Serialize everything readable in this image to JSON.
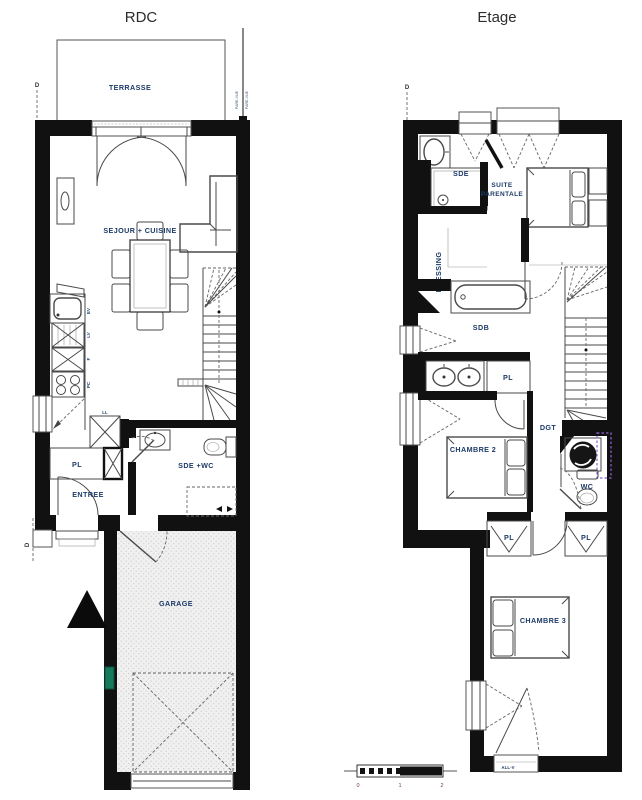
{
  "titles": {
    "rdc": "RDC",
    "etage": "Etage"
  },
  "rdc": {
    "terrasse": "TERRASSE",
    "pare_vue_left": "PARE-VUE",
    "pare_vue_right": "PARE-VUE",
    "sejour_cuisine": "SEJOUR + CUISINE",
    "kitchen": {
      "ev": "EV",
      "lv": "LV",
      "f": "F",
      "pc": "PC",
      "ll": "LL"
    },
    "pl": "PL",
    "entree": "ENTREE",
    "sde_wc": "SDE +WC",
    "garage": "GARAGE",
    "section_marker_top": "D",
    "section_marker_bottom": "D"
  },
  "etage": {
    "sde": "SDE",
    "suite_parentale_line1": "SUITE",
    "suite_parentale_line2": "PARENTALE",
    "dressing": "DRESSING",
    "sdb": "SDB",
    "pl_sdb": "PL",
    "chambre2": "CHAMBRE 2",
    "dgt": "DGT",
    "wc": "WC",
    "pl_left": "PL",
    "pl_right": "PL",
    "chambre3": "CHAMBRE 3",
    "all_v": "ALL-V",
    "section_marker_top": "D"
  },
  "scale_bar": {
    "tick0": "0",
    "tick1": "1",
    "tick2": "2"
  },
  "colors": {
    "wall": "#111111",
    "label": "#1c3a68",
    "line": "#4a4a4a",
    "garage_fill": "#f0f0f0",
    "green_marker": "#15795c",
    "purple_marker": "#8f5fd6",
    "scale_tick": "#7a3c2e"
  }
}
